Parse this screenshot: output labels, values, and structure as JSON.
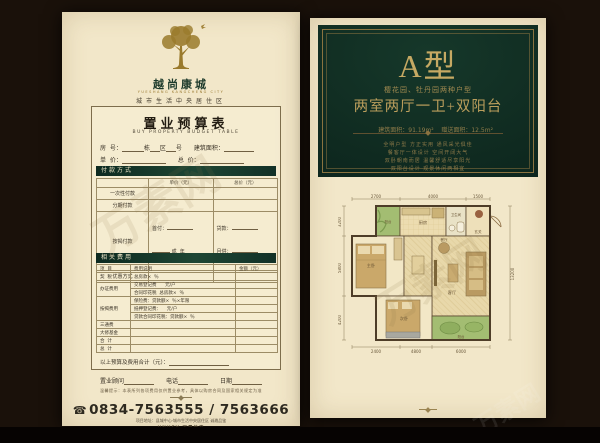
{
  "watermark": {
    "text": "万素网"
  },
  "left": {
    "brand": {
      "name": "越尚康城",
      "latin": "YUESHANG KANGCHENG CITY",
      "tagline": "城市生活中央居住区"
    },
    "form": {
      "title": "置业预算表",
      "subtitle": "BUY PROPERTY BUDGET TABLE",
      "row_no": {
        "l1": "房  号：",
        "l2": "栋",
        "l3": "区",
        "l4": "号",
        "l5": "建筑面积："
      },
      "row_price": {
        "l1": "单  价：",
        "l2": "总  价："
      },
      "payment": {
        "header": "付款方式",
        "col_unit": "单价（元）",
        "col_total": "总价（元）",
        "row_once": "一次性付款",
        "row_installment": "分期付款",
        "row_mortgage": "按揭付款",
        "row_discount": "优惠方式",
        "m_down": "首付：",
        "m_cheng": "成",
        "m_year": "年",
        "m_loan": "贷款：",
        "m_monthly": "月供："
      },
      "fees": {
        "header": "相关费用",
        "col_item": "项  目",
        "col_desc": "费用说明",
        "col_amount": "金额（元）",
        "r1_item": "契  税",
        "r1_d1": "总房款×  ％",
        "r2_item": "办证费用",
        "r2_d1": "交易登记费      元/户",
        "r2_d2": "合同印花税  总房款×  ％",
        "r3_item": "按揭费用",
        "r3_d1": "保险费：贷款额×  ％×年限",
        "r3_d2": "抵押登记费：    元/户",
        "r3_d3": "贷款合同印花税：贷款额×  ％",
        "r4_item": "三通费",
        "r5_item": "大修基金",
        "r6_item": "合  计",
        "r7_item": "总  计"
      },
      "total_label": "以上预算及费用合计（元）：",
      "sign": {
        "consultant": "置业顾问",
        "phone": "电话",
        "date": "日期"
      },
      "disclaimer": "温馨提示：本表所列各项费用仅供置业参考，具体以购房合同及国家相关规定为准"
    },
    "footer": {
      "phone_icon": "☎",
      "phone": "0834-7563555 / 7563666",
      "address": "项目地址：县城中心·城市生活中央居住区  诚邀品鉴",
      "agency": "UNUEY·万晟地产"
    }
  },
  "right": {
    "type_title": "A型",
    "gardens": "樱花园、牡丹园两种户型",
    "layout": "两室两厅一卫+双阳台",
    "area_build": "建筑面积：91.19m²",
    "area_gift": "赠送面积：12.5m²",
    "desc": [
      "全明户型  方正实用  通风采光俱佳",
      "餐客厅一体设计  空间开阔大气",
      "双卧朝南而居  温馨舒适尽享阳光",
      "双阳台设计  观景休闲两相宜"
    ],
    "plan": {
      "labels": {
        "kitchen": "厨房",
        "bath": "卫生间",
        "entry": "玄关",
        "bed1": "主卧",
        "bed2": "次卧",
        "living": "客厅",
        "dining": "餐厅",
        "balcony_top": "阳台",
        "balcony_bottom": "阳台"
      },
      "dims_top": [
        "2700",
        "4000",
        "1500"
      ],
      "dims_left": [
        "3200",
        "5800",
        "4200"
      ],
      "dims_right": [
        "13200"
      ],
      "dims_bottom": [
        "2400",
        "4800",
        "6000"
      ]
    }
  }
}
